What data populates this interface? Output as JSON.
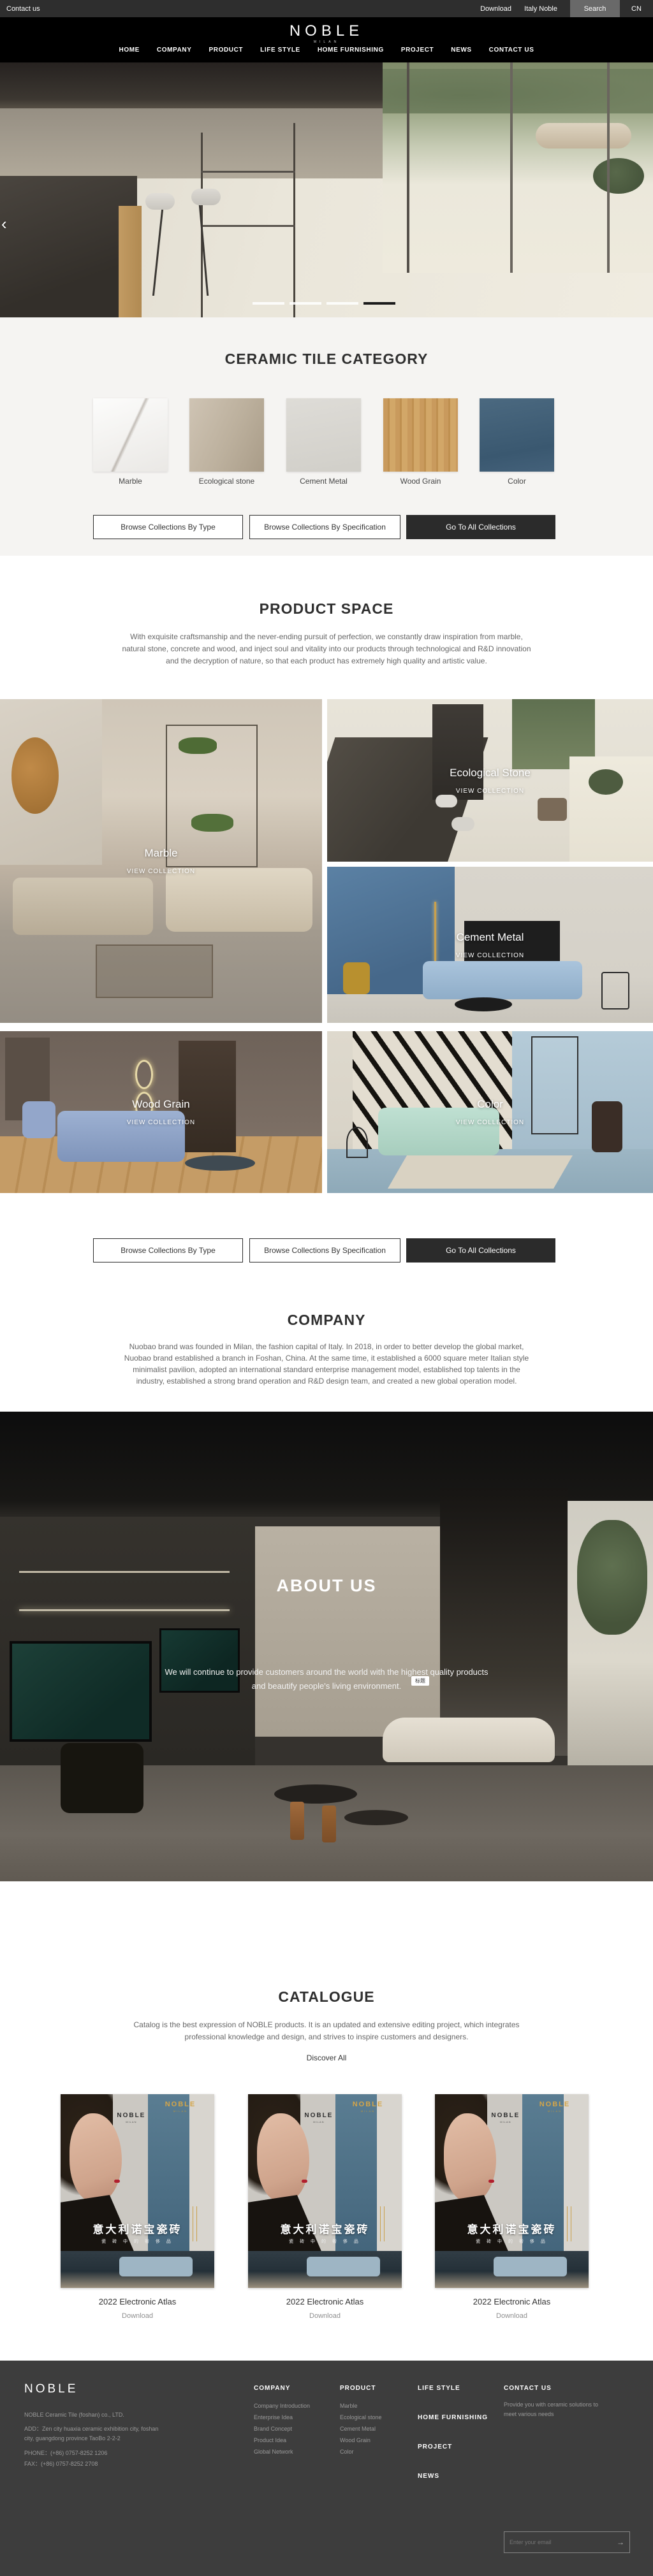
{
  "colors": {
    "topbar_bg": "#2E2E2E",
    "header_bg": "#000000",
    "dark_button": "#2B2B2B",
    "section_bg": "#F5F4F2",
    "footer_bg": "#3D3D3D",
    "cover_blue": "#4E7186",
    "cover_gold": "#D4A548",
    "active_dash": "#1A1A1A"
  },
  "topbar": {
    "contact": "Contact us",
    "download": "Download",
    "italy": "Italy Noble",
    "search": "Search",
    "lang": "CN"
  },
  "header": {
    "logo": "NOBLE",
    "logo_sub": "MILAN",
    "nav": [
      "HOME",
      "COMPANY",
      "PRODUCT",
      "LIFE STYLE",
      "HOME FURNISHING",
      "PROJECT",
      "NEWS",
      "CONTACT US"
    ]
  },
  "hero": {
    "prev_arrow": "‹",
    "slide_count": 4,
    "active_slide_index": 3
  },
  "category": {
    "title": "CERAMIC TILE CATEGORY",
    "items": [
      {
        "label": "Marble"
      },
      {
        "label": "Ecological stone"
      },
      {
        "label": "Cement Metal"
      },
      {
        "label": "Wood Grain"
      },
      {
        "label": "Color"
      }
    ],
    "buttons": {
      "by_type": "Browse Collections By Type",
      "by_spec": "Browse Collections By Specification",
      "all": "Go To All Collections"
    }
  },
  "product_space": {
    "title": "PRODUCT SPACE",
    "paragraph": [
      "With exquisite craftsmanship and the never-ending pursuit of perfection, we constantly draw inspiration from marble,",
      "natural stone, concrete and wood, and inject soul and vitality into our products through technological and R&D innovation",
      "and the decryption of nature, so that each product has extremely high quality and artistic value."
    ],
    "tiles": [
      {
        "name": "Marble",
        "cta": "VIEW COLLECTION"
      },
      {
        "name": "Ecological Stone",
        "cta": "VIEW COLLECTION"
      },
      {
        "name": "Cement Metal",
        "cta": "VIEW COLLECTION"
      },
      {
        "name": "Wood Grain",
        "cta": "VIEW COLLECTION"
      },
      {
        "name": "Color",
        "cta": "VIEW COLLECTION"
      }
    ]
  },
  "company": {
    "title": "COMPANY",
    "paragraph": [
      "Nuobao brand was founded in Milan, the fashion capital of Italy. In 2018, in order to better develop the global market,",
      "Nuobao brand established a branch in Foshan, China. At the same time, it established a 6000 square meter Italian style",
      "minimalist pavilion, adopted an international standard enterprise management model, established top talents in the",
      "industry, established a strong brand operation and R&D design team, and created a new global operation model."
    ]
  },
  "about": {
    "title": "ABOUT US",
    "lines": [
      "We will continue to provide customers around the world with the highest quality products",
      "and beautify people's living environment."
    ],
    "tag": "标题"
  },
  "catalogue": {
    "title": "CATALOGUE",
    "paragraph": [
      "Catalog is the best expression of NOBLE products. It is an updated and extensive editing project, which integrates",
      "professional knowledge and design, and strives to inspire customers and designers."
    ],
    "discover": "Discover All",
    "cover": {
      "brand": "NOBLE",
      "brand_sub": "MILAN",
      "wall_brand": "NOBLE",
      "wall_brand_sub": "MILAN",
      "title_cn": "意大利诺宝瓷砖",
      "subtitle_cn": "瓷 砖 中 的 奢 侈 品"
    },
    "items": [
      {
        "label": "2022 Electronic Atlas",
        "download": "Download"
      },
      {
        "label": "2022 Electronic Atlas",
        "download": "Download"
      },
      {
        "label": "2022 Electronic Atlas",
        "download": "Download"
      }
    ]
  },
  "footer": {
    "logo": "NOBLE",
    "company_name": "NOBLE Ceramic Tile (foshan) co., LTD.",
    "address_line1": "ADD：Zen city huaxia ceramic exhibition city, foshan",
    "address_line2": "city, guangdong province TaoBo 2-2-2",
    "phone": "PHONE：(+86) 0757-8252 1206",
    "fax": "FAX：(+86) 0757-8252 2708",
    "columns": [
      {
        "title": "COMPANY",
        "items": [
          "Company Introduction",
          "Enterprise Idea",
          "Brand Concept",
          "Product Idea",
          "Global Network"
        ]
      },
      {
        "title": "PRODUCT",
        "items": [
          "Marble",
          "Ecological stone",
          "Cement Metal",
          "Wood Grain",
          "Color"
        ]
      }
    ],
    "nav_links": [
      "LIFE STYLE",
      "HOME FURNISHING",
      "PROJECT",
      "NEWS"
    ],
    "contact": {
      "title": "CONTACT US",
      "text": "Provide you with ceramic solutions to meet various needs",
      "email_placeholder": "Enter your email"
    }
  }
}
